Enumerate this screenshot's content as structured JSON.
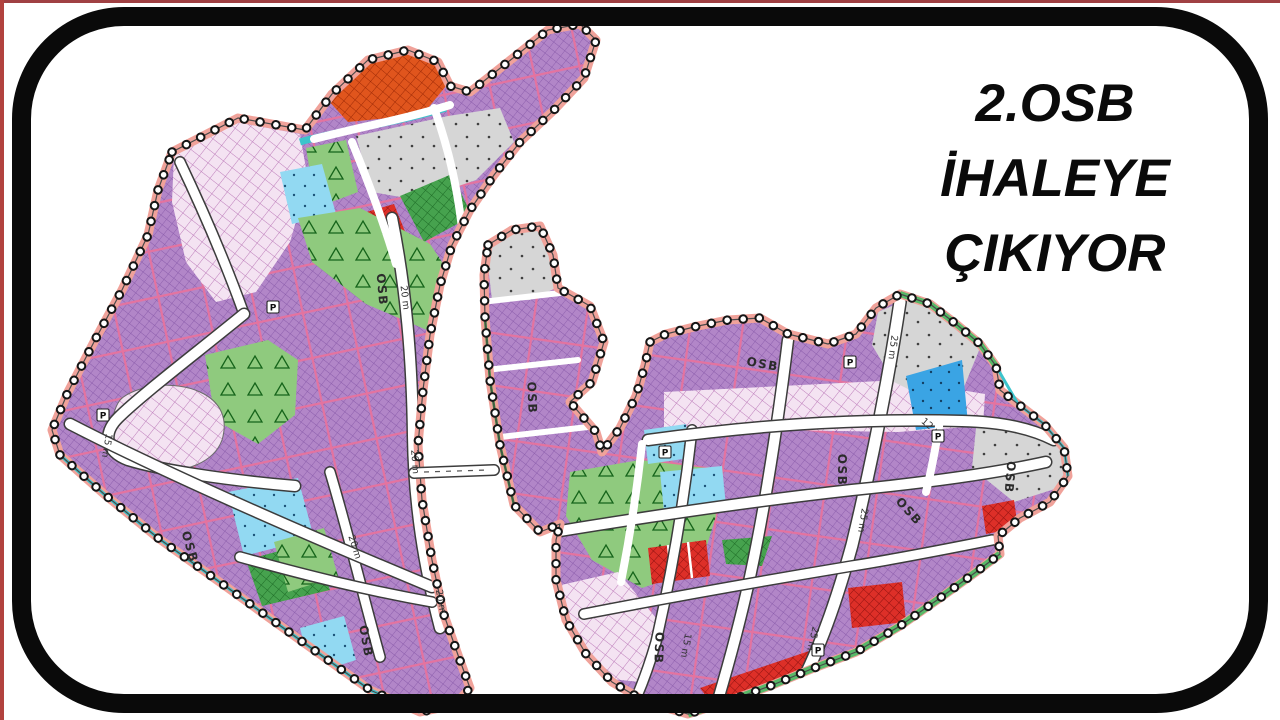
{
  "headline": {
    "lines": [
      "2.OSB",
      "İHALEYE",
      "ÇIKIYOR"
    ],
    "color": "#0a0a0a"
  },
  "frame": {
    "border_color": "#0a0a0a",
    "top_edge_color": "#a04043",
    "left_edge_color": "#b2423e",
    "background": "#ffffff"
  },
  "map": {
    "palette": {
      "purple": "#b286c8",
      "purplehatch": "#8a5cab",
      "pinkline": "#e4739f",
      "salmon": "#f0a29a",
      "teal": "#3cc4cc",
      "orange": "#e0551d",
      "red": "#dd2f28",
      "greenlight": "#8fca7e",
      "greendark": "#46a24e",
      "greenband": "#58b868",
      "gray": "#d6d6d6",
      "bluelight": "#92d9f2",
      "bluemid": "#3aa4e4",
      "pinkpale": "#f4e3f2",
      "road": "#ffffff"
    },
    "p_label": "P",
    "p_markers": [
      {
        "x": 273,
        "y": 307
      },
      {
        "x": 850,
        "y": 362
      },
      {
        "x": 665,
        "y": 452
      },
      {
        "x": 103,
        "y": 415
      },
      {
        "x": 938,
        "y": 436
      },
      {
        "x": 818,
        "y": 650
      }
    ],
    "labels": [
      {
        "kind": "osb",
        "text": "OSB",
        "x": 378,
        "y": 290,
        "rot": 85
      },
      {
        "kind": "osb",
        "text": "OSB",
        "x": 186,
        "y": 548,
        "rot": 74
      },
      {
        "kind": "osb",
        "text": "OSB",
        "x": 528,
        "y": 398,
        "rot": 88
      },
      {
        "kind": "osb",
        "text": "OSB",
        "x": 362,
        "y": 642,
        "rot": 80
      },
      {
        "kind": "osb",
        "text": "OSB",
        "x": 762,
        "y": 368,
        "rot": 10
      },
      {
        "kind": "osb",
        "text": "OSB",
        "x": 838,
        "y": 470,
        "rot": 90
      },
      {
        "kind": "osb",
        "text": "OSB",
        "x": 1006,
        "y": 477,
        "rot": 95
      },
      {
        "kind": "osb",
        "text": "OSB",
        "x": 655,
        "y": 648,
        "rot": 92
      },
      {
        "kind": "osb",
        "text": "OSB",
        "x": 906,
        "y": 514,
        "rot": 48
      },
      {
        "kind": "road",
        "text": "20 m",
        "x": 402,
        "y": 298,
        "rot": 83
      },
      {
        "kind": "road",
        "text": "20 m",
        "x": 412,
        "y": 462,
        "rot": 86
      },
      {
        "kind": "road",
        "text": "20 m",
        "x": 438,
        "y": 602,
        "rot": 80
      },
      {
        "kind": "road",
        "text": "20 m",
        "x": 352,
        "y": 548,
        "rot": 72
      },
      {
        "kind": "road",
        "text": "25 m",
        "x": 890,
        "y": 347,
        "rot": 97
      },
      {
        "kind": "road",
        "text": "25 m",
        "x": 860,
        "y": 520,
        "rot": 99
      },
      {
        "kind": "road",
        "text": "25 m",
        "x": 810,
        "y": 638,
        "rot": 103
      },
      {
        "kind": "road",
        "text": "15 m",
        "x": 104,
        "y": 445,
        "rot": 100
      },
      {
        "kind": "road",
        "text": "15 m",
        "x": 683,
        "y": 645,
        "rot": 100
      },
      {
        "kind": "road",
        "text": "12 m",
        "x": 930,
        "y": 430,
        "rot": 40
      }
    ]
  }
}
